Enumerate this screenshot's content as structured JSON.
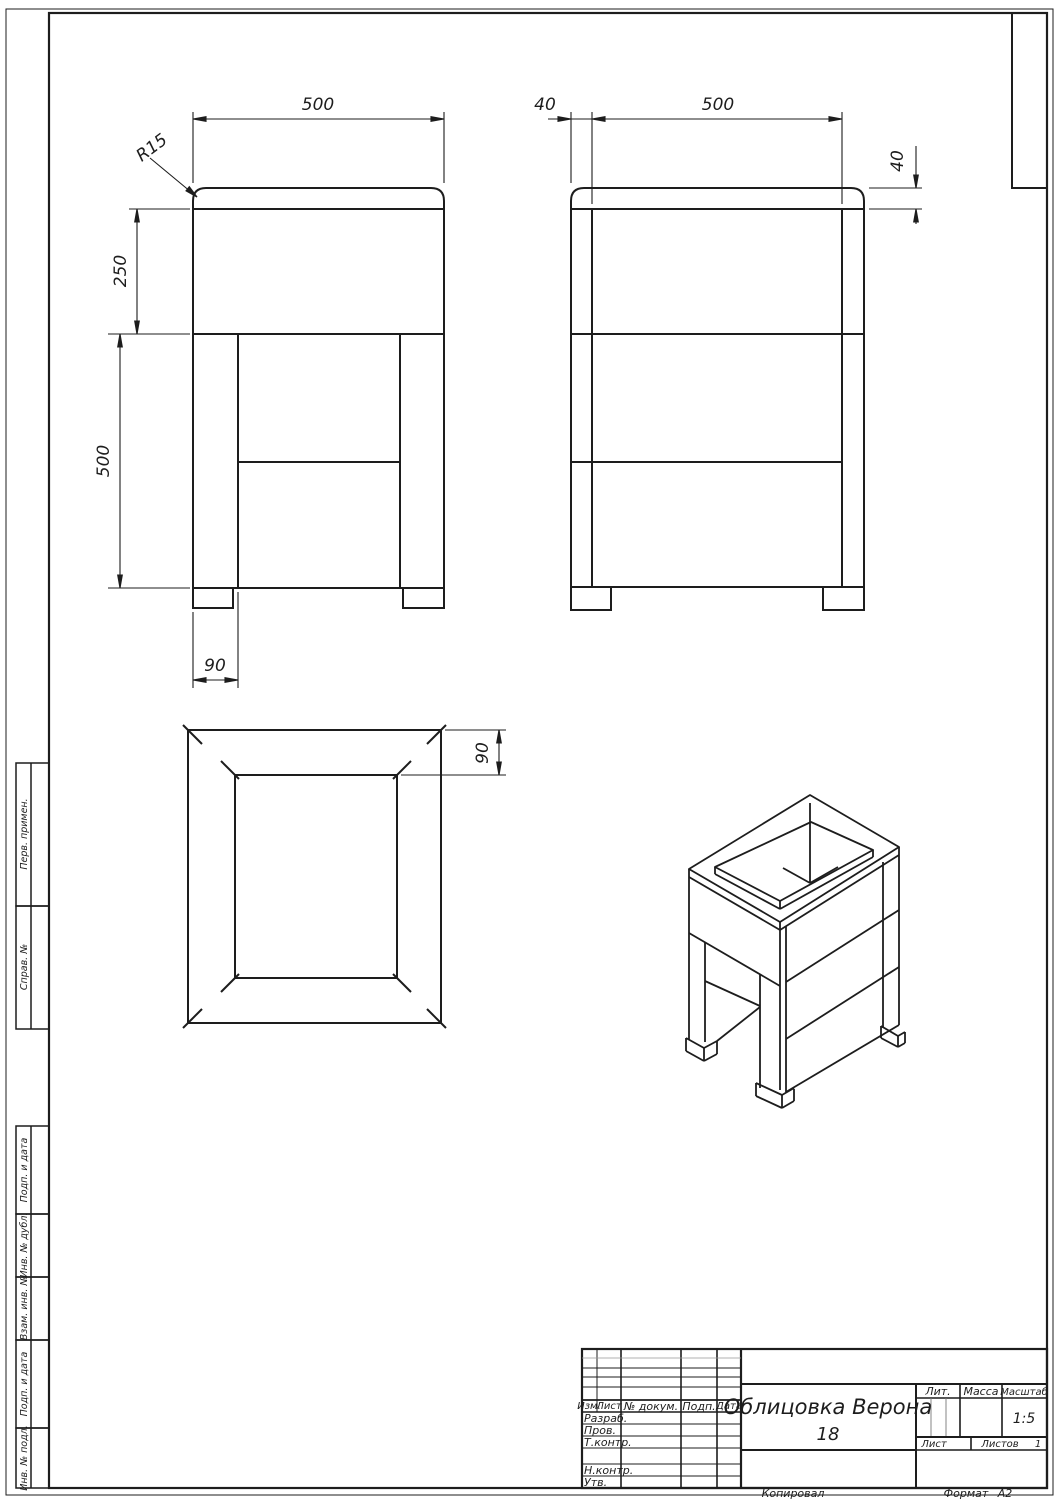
{
  "drawing": {
    "title": "Облицовка Верона",
    "sheet_number": "18",
    "scale_value": "1:5",
    "sheets_total": "1",
    "format_value": "А2",
    "kopiroval": "Копировал",
    "format_label": "Формат"
  },
  "title_block": {
    "col_izm": "Изм.",
    "col_list": "Лист",
    "col_doc": "№ докум.",
    "col_podp": "Подп.",
    "col_data": "Дата",
    "row_razrab": "Разраб.",
    "row_prov": "Пров.",
    "row_tkontr": "Т.контр.",
    "row_nkontr": "Н.контр.",
    "row_utv": "Утв.",
    "lit_label": "Лит.",
    "massa_label": "Масса",
    "masshtab_label": "Масштаб",
    "list_label": "Лист",
    "listov_label": "Листов"
  },
  "margin_stamps": {
    "perv_primen": "Перв. примен.",
    "sprav_no": "Справ. №",
    "podp_data_1": "Подп. и дата",
    "inv_dubl": "Инв. № дубл.",
    "vzam_inv": "Взам. инв. №",
    "podp_data_2": "Подп. и дата",
    "inv_podl": "Инв. № подл."
  },
  "dimensions": {
    "front_width": "500",
    "front_radius": "R15",
    "front_top_height": "250",
    "front_leg_height": "500",
    "front_leg_width": "90",
    "side_left_offset": "40",
    "side_width": "500",
    "side_top_thickness": "40",
    "top_frame_border": "90"
  }
}
